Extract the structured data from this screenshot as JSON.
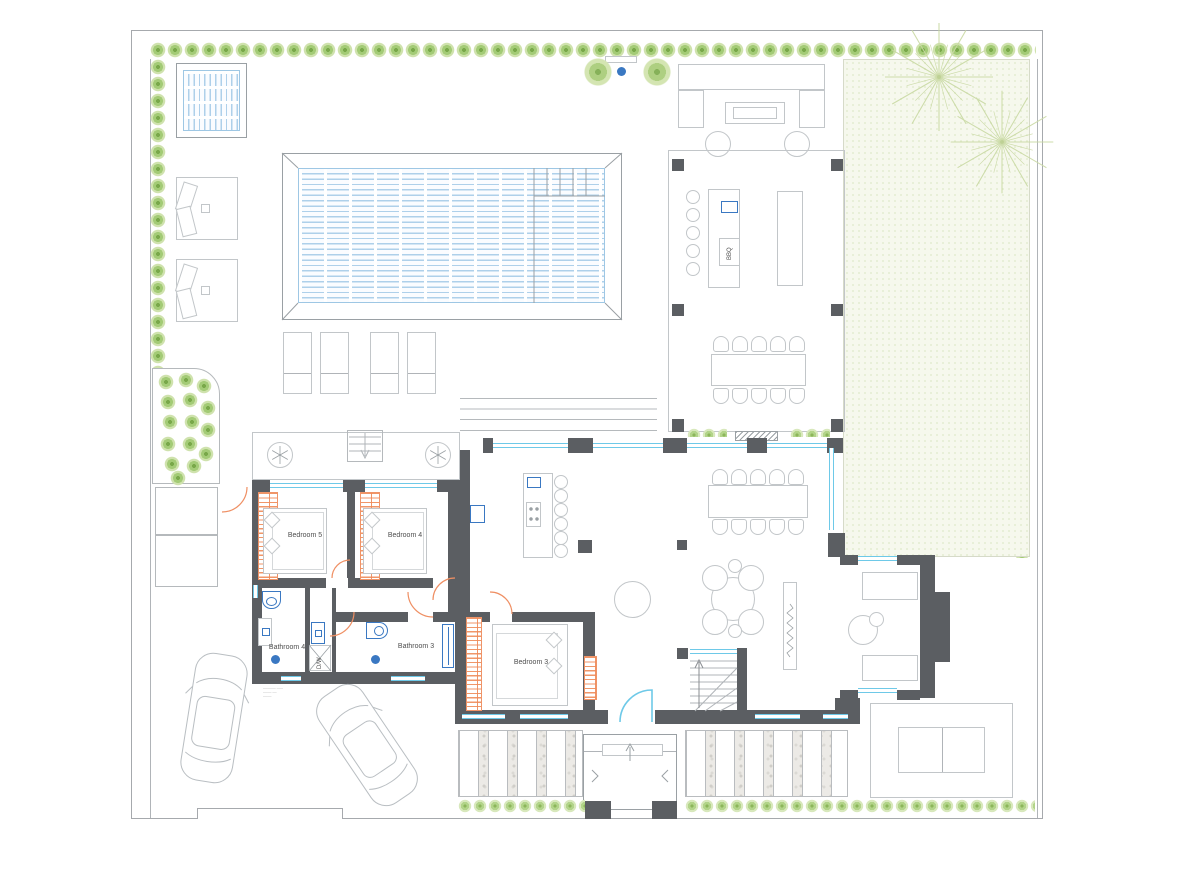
{
  "plan": {
    "labels": {
      "bedroom5": "Bedroom 5",
      "bedroom4": "Bedroom 4",
      "bedroom3": "Bedroom 3",
      "bathroom4": "Bathroom 4",
      "bathroom3": "Bathroom 3",
      "laundry": "D/W",
      "bbq": "BBQ"
    },
    "fine_print": {
      "line1": "────── ───",
      "line2": "──── ──",
      "line3": "────"
    },
    "colors": {
      "wall_gray": "#5b5e62",
      "window_glass_cyan": "#6ec9e8",
      "plumbing_blue": "#3a78c2",
      "door_swing_orange": "#ef8f63",
      "hedge_green": "#79a84a",
      "lawn_green": "#f6f8ed",
      "pool_water_blue": "#aed0ea"
    }
  }
}
